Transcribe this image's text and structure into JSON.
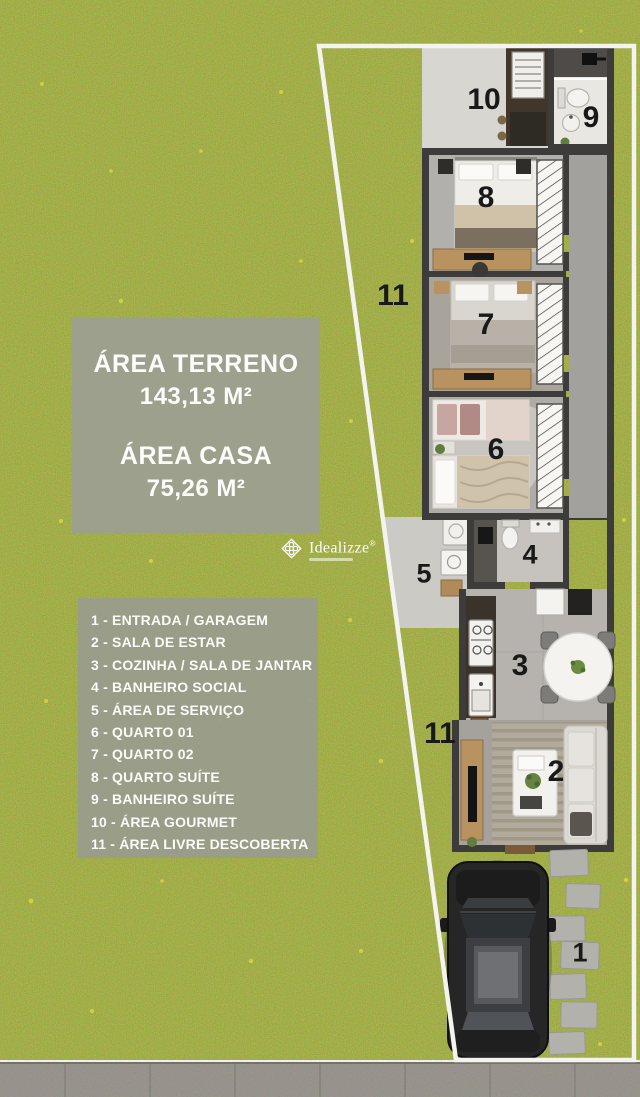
{
  "info_panel": {
    "area_terreno_label": "ÁREA TERRENO",
    "area_terreno_value": "143,13 M²",
    "area_casa_label": "ÁREA CASA",
    "area_casa_value": "75,26 M²"
  },
  "logo": {
    "brand": "Idealizze",
    "registered_mark": "®"
  },
  "legend": {
    "items": [
      "1 - ENTRADA / GARAGEM",
      "2 - SALA DE ESTAR",
      "3 - COZINHA / SALA DE JANTAR",
      "4 - BANHEIRO SOCIAL",
      "5 - ÁREA DE SERVIÇO",
      "6 - QUARTO 01",
      "7 - QUARTO 02",
      "8 - QUARTO SUÍTE",
      "9 - BANHEIRO SUÍTE",
      "10 - ÁREA GOURMET",
      "11 - ÁREA LIVRE DESCOBERTA"
    ]
  },
  "plan_labels": {
    "garage": "1",
    "living": "2",
    "kitchen_dining": "3",
    "bathroom_social": "4",
    "service_area": "5",
    "bedroom_01": "6",
    "bedroom_02": "7",
    "bedroom_suite": "8",
    "bathroom_suite": "9",
    "gourmet": "10",
    "open_area_top": "11",
    "open_area_bottom": "11"
  },
  "colors": {
    "grass": "#8e993d",
    "panel_background": "#9c9f90",
    "wall": "#3d3c3a",
    "lot_outline": "#f4f3f0",
    "floor_light": "#d8d6d1",
    "sidewalk": "#8f8c86"
  }
}
